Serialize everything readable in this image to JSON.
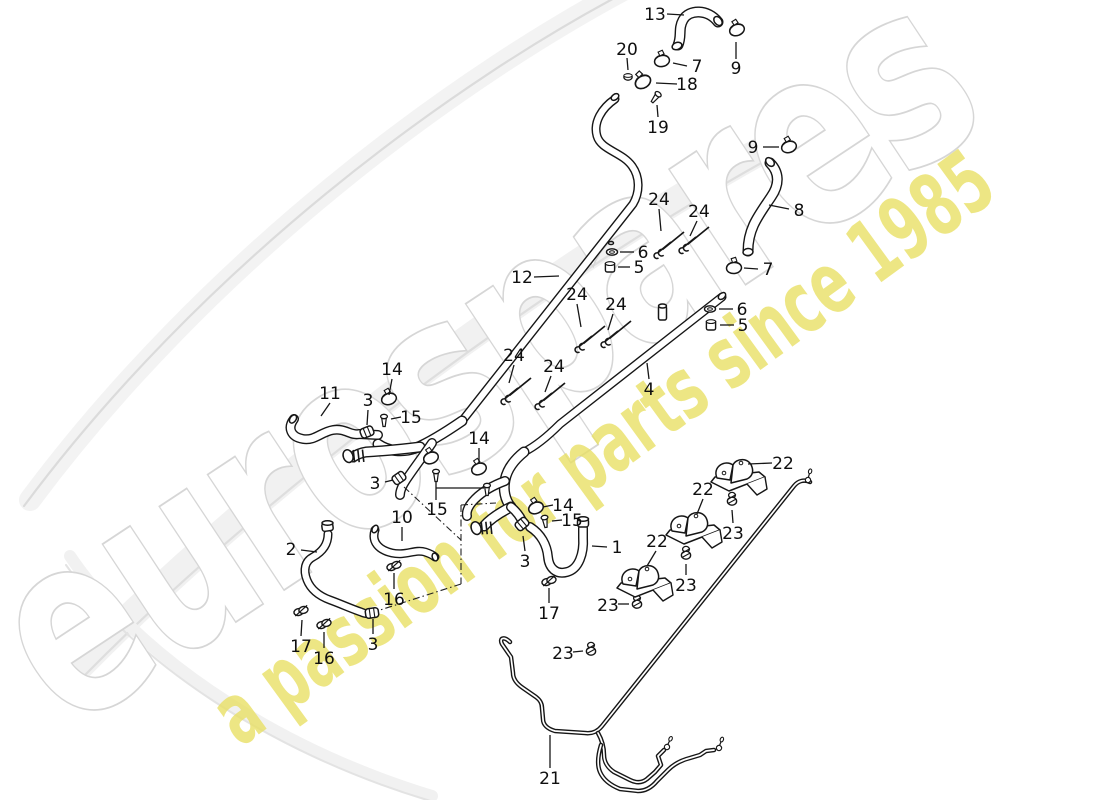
{
  "watermarks": {
    "brand": "eurospares",
    "brand_outline_color": "#d6d6d6",
    "tagline": "a passion for parts since 1985",
    "tagline_color": "#e9e062"
  },
  "callouts": [
    {
      "n": "13",
      "x": 655,
      "y": 14,
      "l": [
        667,
        14,
        684,
        15
      ]
    },
    {
      "n": "9",
      "x": 736,
      "y": 68,
      "l": [
        736,
        59,
        736,
        42
      ]
    },
    {
      "n": "20",
      "x": 627,
      "y": 49,
      "l": [
        627,
        58,
        628,
        70
      ]
    },
    {
      "n": "7",
      "x": 697,
      "y": 66,
      "l": [
        687,
        66,
        673,
        63
      ]
    },
    {
      "n": "18",
      "x": 687,
      "y": 84,
      "l": [
        677,
        84,
        656,
        83
      ]
    },
    {
      "n": "19",
      "x": 658,
      "y": 127,
      "l": [
        658,
        117,
        657,
        105
      ]
    },
    {
      "n": "9",
      "x": 753,
      "y": 147,
      "l": [
        763,
        147,
        779,
        147
      ]
    },
    {
      "n": "8",
      "x": 799,
      "y": 210,
      "l": [
        789,
        209,
        769,
        205
      ]
    },
    {
      "n": "7",
      "x": 768,
      "y": 269,
      "l": [
        758,
        269,
        744,
        268
      ]
    },
    {
      "n": "6",
      "x": 643,
      "y": 252,
      "l": [
        634,
        252,
        620,
        252
      ]
    },
    {
      "n": "5",
      "x": 639,
      "y": 267,
      "l": [
        630,
        267,
        618,
        267
      ]
    },
    {
      "n": "6",
      "x": 742,
      "y": 309,
      "l": [
        733,
        309,
        719,
        309
      ]
    },
    {
      "n": "5",
      "x": 743,
      "y": 325,
      "l": [
        734,
        325,
        720,
        325
      ]
    },
    {
      "n": "12",
      "x": 522,
      "y": 277,
      "l": [
        534,
        277,
        559,
        276
      ]
    },
    {
      "n": "4",
      "x": 649,
      "y": 389,
      "l": [
        649,
        379,
        647,
        363
      ]
    },
    {
      "n": "24",
      "x": 659,
      "y": 199,
      "l": [
        659,
        209,
        661,
        231
      ]
    },
    {
      "n": "24",
      "x": 699,
      "y": 211,
      "l": [
        697,
        221,
        690,
        236
      ]
    },
    {
      "n": "24",
      "x": 577,
      "y": 294,
      "l": [
        577,
        304,
        581,
        327
      ]
    },
    {
      "n": "24",
      "x": 616,
      "y": 304,
      "l": [
        613,
        314,
        608,
        330
      ]
    },
    {
      "n": "24",
      "x": 514,
      "y": 355,
      "l": [
        514,
        365,
        509,
        383
      ]
    },
    {
      "n": "24",
      "x": 554,
      "y": 366,
      "l": [
        551,
        376,
        545,
        392
      ]
    },
    {
      "n": "11",
      "x": 330,
      "y": 393,
      "l": [
        330,
        403,
        321,
        416
      ]
    },
    {
      "n": "3",
      "x": 368,
      "y": 400,
      "l": [
        368,
        410,
        367,
        425
      ]
    },
    {
      "n": "14",
      "x": 392,
      "y": 369,
      "l": [
        392,
        379,
        389,
        395
      ]
    },
    {
      "n": "15",
      "x": 411,
      "y": 417,
      "l": [
        401,
        417,
        391,
        419
      ]
    },
    {
      "n": "3",
      "x": 375,
      "y": 483,
      "l": [
        385,
        482,
        393,
        480
      ]
    },
    {
      "n": "14",
      "x": 479,
      "y": 438,
      "l": [
        479,
        448,
        479,
        463
      ]
    },
    {
      "n": "15",
      "x": 437,
      "y": 509,
      "l": [
        436,
        500,
        436,
        481
      ]
    },
    {
      "n": "10",
      "x": 402,
      "y": 517,
      "l": [
        402,
        527,
        402,
        541
      ]
    },
    {
      "n": "2",
      "x": 291,
      "y": 549,
      "l": [
        301,
        550,
        317,
        552
      ]
    },
    {
      "n": "14",
      "x": 563,
      "y": 505,
      "l": [
        553,
        505,
        543,
        507
      ]
    },
    {
      "n": "15",
      "x": 572,
      "y": 520,
      "l": [
        562,
        520,
        552,
        521
      ]
    },
    {
      "n": "3",
      "x": 525,
      "y": 561,
      "l": [
        525,
        551,
        523,
        536
      ]
    },
    {
      "n": "1",
      "x": 617,
      "y": 547,
      "l": [
        607,
        547,
        592,
        546
      ]
    },
    {
      "n": "17",
      "x": 549,
      "y": 613,
      "l": [
        549,
        603,
        549,
        588
      ]
    },
    {
      "n": "16",
      "x": 394,
      "y": 599,
      "l": [
        394,
        589,
        394,
        573
      ]
    },
    {
      "n": "17",
      "x": 301,
      "y": 646,
      "l": [
        301,
        636,
        302,
        620
      ]
    },
    {
      "n": "16",
      "x": 324,
      "y": 658,
      "l": [
        324,
        648,
        324,
        632
      ]
    },
    {
      "n": "3",
      "x": 373,
      "y": 644,
      "l": [
        373,
        634,
        373,
        619
      ]
    },
    {
      "n": "22",
      "x": 783,
      "y": 463,
      "l": [
        772,
        463,
        748,
        464
      ]
    },
    {
      "n": "22",
      "x": 703,
      "y": 489,
      "l": [
        703,
        499,
        697,
        514
      ]
    },
    {
      "n": "22",
      "x": 657,
      "y": 541,
      "l": [
        656,
        551,
        647,
        566
      ]
    },
    {
      "n": "23",
      "x": 733,
      "y": 533,
      "l": [
        733,
        523,
        732,
        510
      ]
    },
    {
      "n": "23",
      "x": 686,
      "y": 585,
      "l": [
        686,
        575,
        686,
        564
      ]
    },
    {
      "n": "23",
      "x": 608,
      "y": 605,
      "l": [
        618,
        604,
        629,
        604
      ]
    },
    {
      "n": "23",
      "x": 563,
      "y": 653,
      "l": [
        573,
        652,
        583,
        651
      ]
    },
    {
      "n": "21",
      "x": 550,
      "y": 778,
      "l": [
        550,
        768,
        550,
        735
      ]
    }
  ]
}
